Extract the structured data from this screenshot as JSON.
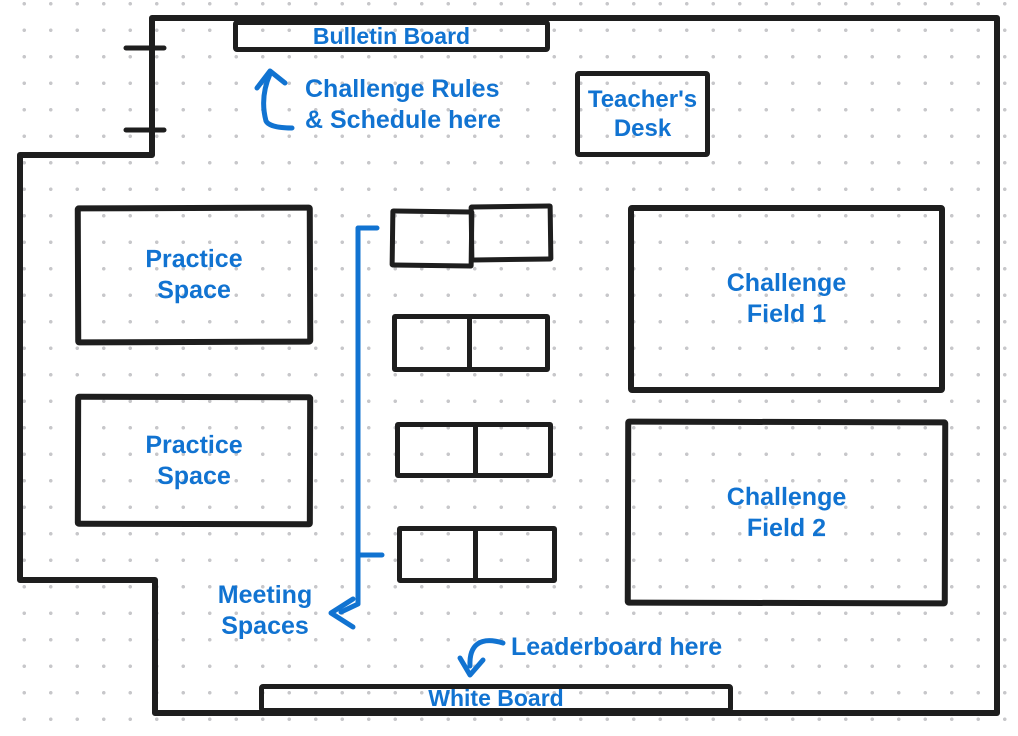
{
  "colors": {
    "annotation": "#1173d1",
    "wall": "#1e1e1e",
    "dot": "#c7c7ca"
  },
  "boards": {
    "bulletin": "Bulletin Board",
    "white": "White Board"
  },
  "rooms": {
    "teachers_desk": {
      "line1": "Teacher's",
      "line2": "Desk"
    },
    "practice_1": {
      "line1": "Practice",
      "line2": "Space"
    },
    "practice_2": {
      "line1": "Practice",
      "line2": "Space"
    },
    "challenge_1": {
      "line1": "Challenge",
      "line2": "Field 1"
    },
    "challenge_2": {
      "line1": "Challenge",
      "line2": "Field 2"
    }
  },
  "annotations": {
    "rules": {
      "line1": "Challenge Rules",
      "line2": "& Schedule here"
    },
    "meeting": {
      "line1": "Meeting",
      "line2": "Spaces"
    },
    "leaderboard": "Leaderboard here"
  }
}
